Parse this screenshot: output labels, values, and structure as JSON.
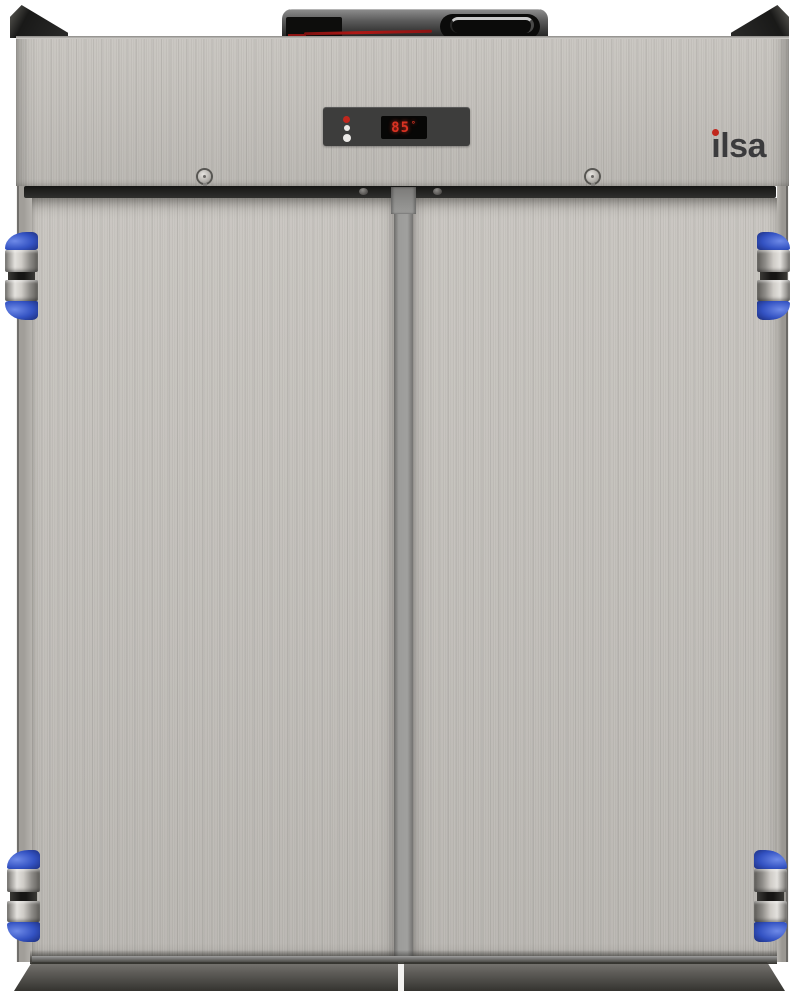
{
  "image": {
    "description": "Product photo of an ILSA two-door stainless steel upright refrigerator on a white background"
  },
  "brand_logo": {
    "text": "ilsa",
    "stem_text": "ı",
    "rest_text": "lsa",
    "dot_color": "#c1271d",
    "text_color": "#3b3b3d"
  },
  "control_panel": {
    "display_value": "85",
    "degree_mark": "°",
    "display_text_color": "#d93222",
    "panel_background": "#3d3d3c",
    "indicator_icon": "ilsa-i-indicator"
  },
  "hardware": {
    "visible_hinges": 4,
    "hinge_accent_color": "#3352c2",
    "screw_positions": [
      "header-left",
      "header-right",
      "band-center-left",
      "band-center-right"
    ]
  },
  "top_unit": {
    "name": "condensing-unit",
    "tube_color": "#9e1512"
  },
  "materials": {
    "steel_light": "#c9c6c1",
    "steel_mid": "#bab7b2",
    "mullion_gray": "#9c9c9a",
    "band_dark": "#1f1f1e",
    "plinth_dark": "#454440"
  }
}
